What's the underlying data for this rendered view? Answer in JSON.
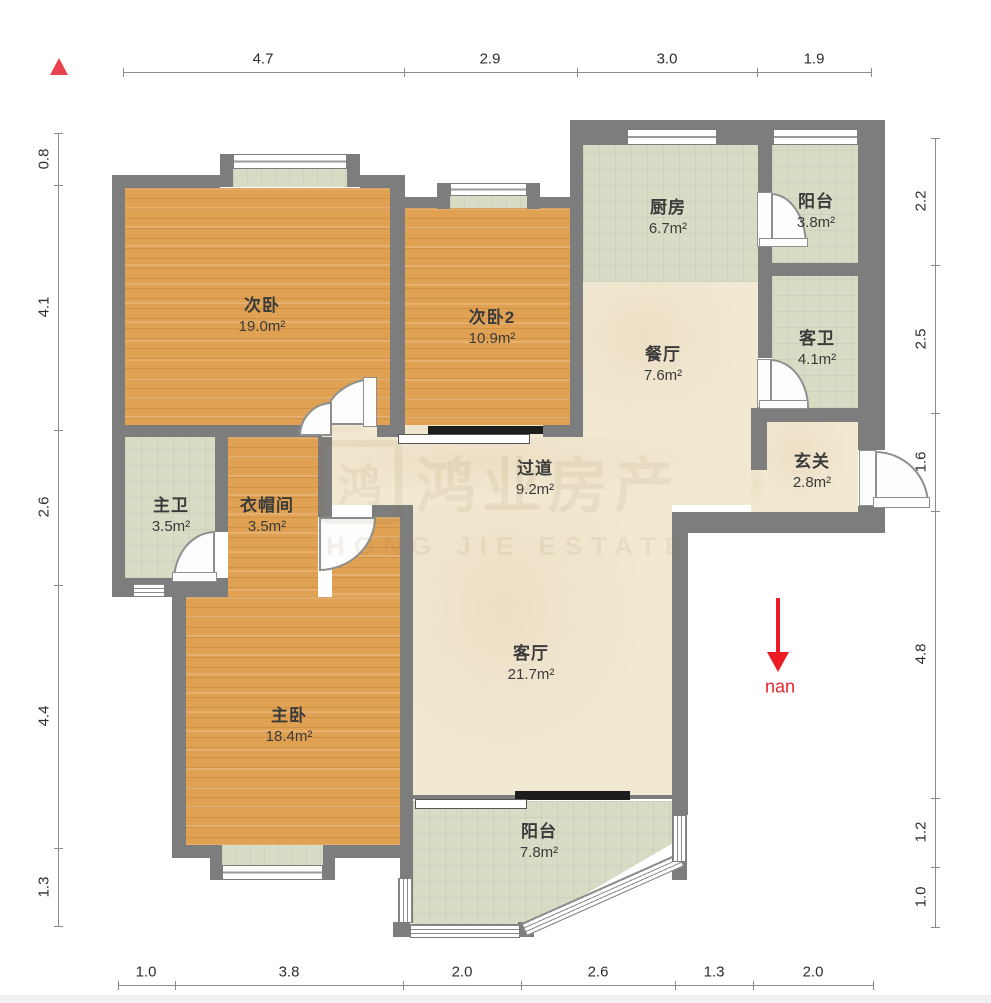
{
  "compass": {
    "south_label": "nan"
  },
  "watermark": {
    "logo": "鸿",
    "cn": "鸿业房产",
    "en": "HONG JIE ESTATE"
  },
  "colors": {
    "wall": "#7d7d7d",
    "wood": "#e0a153",
    "tile": "#d9dcc5",
    "cream": "#f2e9d3",
    "accent_red": "#ed1c24"
  },
  "rooms": {
    "ci_bedroom": {
      "name": "次卧",
      "area": "19.0m²"
    },
    "ci_bedroom2": {
      "name": "次卧2",
      "area": "10.9m²"
    },
    "kitchen": {
      "name": "厨房",
      "area": "6.7m²"
    },
    "balcony_top": {
      "name": "阳台",
      "area": "3.8m²"
    },
    "dining": {
      "name": "餐厅",
      "area": "7.6m²"
    },
    "guest_bath": {
      "name": "客卫",
      "area": "4.1m²"
    },
    "hallway": {
      "name": "过道",
      "area": "9.2m²"
    },
    "entry": {
      "name": "玄关",
      "area": "2.8m²"
    },
    "master_bath": {
      "name": "主卫",
      "area": "3.5m²"
    },
    "cloakroom": {
      "name": "衣帽间",
      "area": "3.5m²"
    },
    "master_bedroom": {
      "name": "主卧",
      "area": "18.4m²"
    },
    "living": {
      "name": "客厅",
      "area": "21.7m²"
    },
    "balcony_bottom": {
      "name": "阳台",
      "area": "7.8m²"
    }
  },
  "dims": {
    "top": [
      "4.7",
      "2.9",
      "3.0",
      "1.9"
    ],
    "left": [
      "0.8",
      "4.1",
      "2.6",
      "4.4",
      "1.3"
    ],
    "right": [
      "2.2",
      "2.5",
      "1.6",
      "4.8",
      "1.2",
      "1.0"
    ],
    "bottom": [
      "1.0",
      "3.8",
      "2.0",
      "2.6",
      "1.3",
      "2.0"
    ]
  }
}
